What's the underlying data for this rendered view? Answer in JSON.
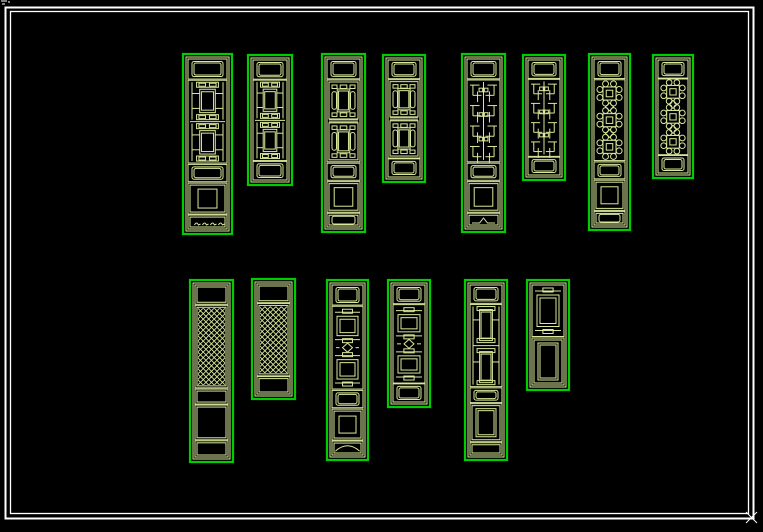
{
  "meta": {
    "description": "CAD drawing of traditional Chinese lattice door panels, two rows, green linework on black",
    "background": "#000000"
  },
  "colors": {
    "panel_border": "#00cd00",
    "lattice_line": "#d9e89b",
    "frame_white": "#ffffff",
    "background": "#000000"
  },
  "frame": {
    "outer": {
      "x": 5.5,
      "y": 7.5,
      "w": 748,
      "h": 511,
      "stroke_width": 2
    },
    "inner": {
      "x": 10.5,
      "y": 11.5,
      "w": 738,
      "h": 502,
      "stroke_width": 1.3
    }
  },
  "artifacts": {
    "top_left_specks": [
      [
        1,
        1,
        7,
        1
      ],
      [
        2,
        4,
        5,
        4
      ],
      [
        8,
        2,
        10,
        2
      ]
    ],
    "bottom_right_cross": [
      [
        746,
        512,
        757,
        523
      ],
      [
        757,
        512,
        746,
        523
      ]
    ]
  },
  "rows": [
    {
      "name": "top-row",
      "panel_count": 8
    },
    {
      "name": "bottom-row",
      "panel_count": 6
    }
  ],
  "panels": [
    {
      "id": "top-1",
      "row": 0,
      "pattern": "A",
      "kind": "tall",
      "x": 183,
      "y": 54,
      "w": 49,
      "h": 180,
      "base_decor": "marks"
    },
    {
      "id": "top-2",
      "row": 0,
      "pattern": "A",
      "kind": "short",
      "x": 248,
      "y": 55,
      "w": 44,
      "h": 130
    },
    {
      "id": "top-3",
      "row": 0,
      "pattern": "B",
      "kind": "tall",
      "x": 322,
      "y": 54,
      "w": 43,
      "h": 178,
      "base_decor": "pill"
    },
    {
      "id": "top-4",
      "row": 0,
      "pattern": "B",
      "kind": "short",
      "x": 383,
      "y": 55,
      "w": 42,
      "h": 127
    },
    {
      "id": "top-5",
      "row": 0,
      "pattern": "C",
      "kind": "tall",
      "x": 462,
      "y": 54,
      "w": 43,
      "h": 178,
      "base_decor": "peak"
    },
    {
      "id": "top-6",
      "row": 0,
      "pattern": "C",
      "kind": "short",
      "x": 523,
      "y": 55,
      "w": 42,
      "h": 125
    },
    {
      "id": "top-7",
      "row": 0,
      "pattern": "D",
      "kind": "tall",
      "x": 589,
      "y": 54,
      "w": 41,
      "h": 176,
      "base_decor": "pill"
    },
    {
      "id": "top-8",
      "row": 0,
      "pattern": "D",
      "kind": "short",
      "x": 653,
      "y": 55,
      "w": 40,
      "h": 123
    },
    {
      "id": "bottom-1",
      "row": 1,
      "pattern": "E",
      "kind": "tall-plain",
      "x": 190,
      "y": 280,
      "w": 43,
      "h": 182,
      "base_decor": "plain"
    },
    {
      "id": "bottom-2",
      "row": 1,
      "pattern": "E",
      "kind": "short-plain",
      "x": 252,
      "y": 279,
      "w": 43,
      "h": 120
    },
    {
      "id": "bottom-3",
      "row": 1,
      "pattern": "F",
      "kind": "tall",
      "x": 327,
      "y": 280,
      "w": 41,
      "h": 180,
      "base_decor": "bracket"
    },
    {
      "id": "bottom-4",
      "row": 1,
      "pattern": "F",
      "kind": "short",
      "x": 388,
      "y": 280,
      "w": 42,
      "h": 127
    },
    {
      "id": "bottom-5",
      "row": 1,
      "pattern": "G",
      "kind": "tall-5",
      "x": 465,
      "y": 280,
      "w": 42,
      "h": 180
    },
    {
      "id": "bottom-6",
      "row": 1,
      "pattern": "H",
      "kind": "lattice-board",
      "x": 527,
      "y": 280,
      "w": 42,
      "h": 110
    }
  ]
}
